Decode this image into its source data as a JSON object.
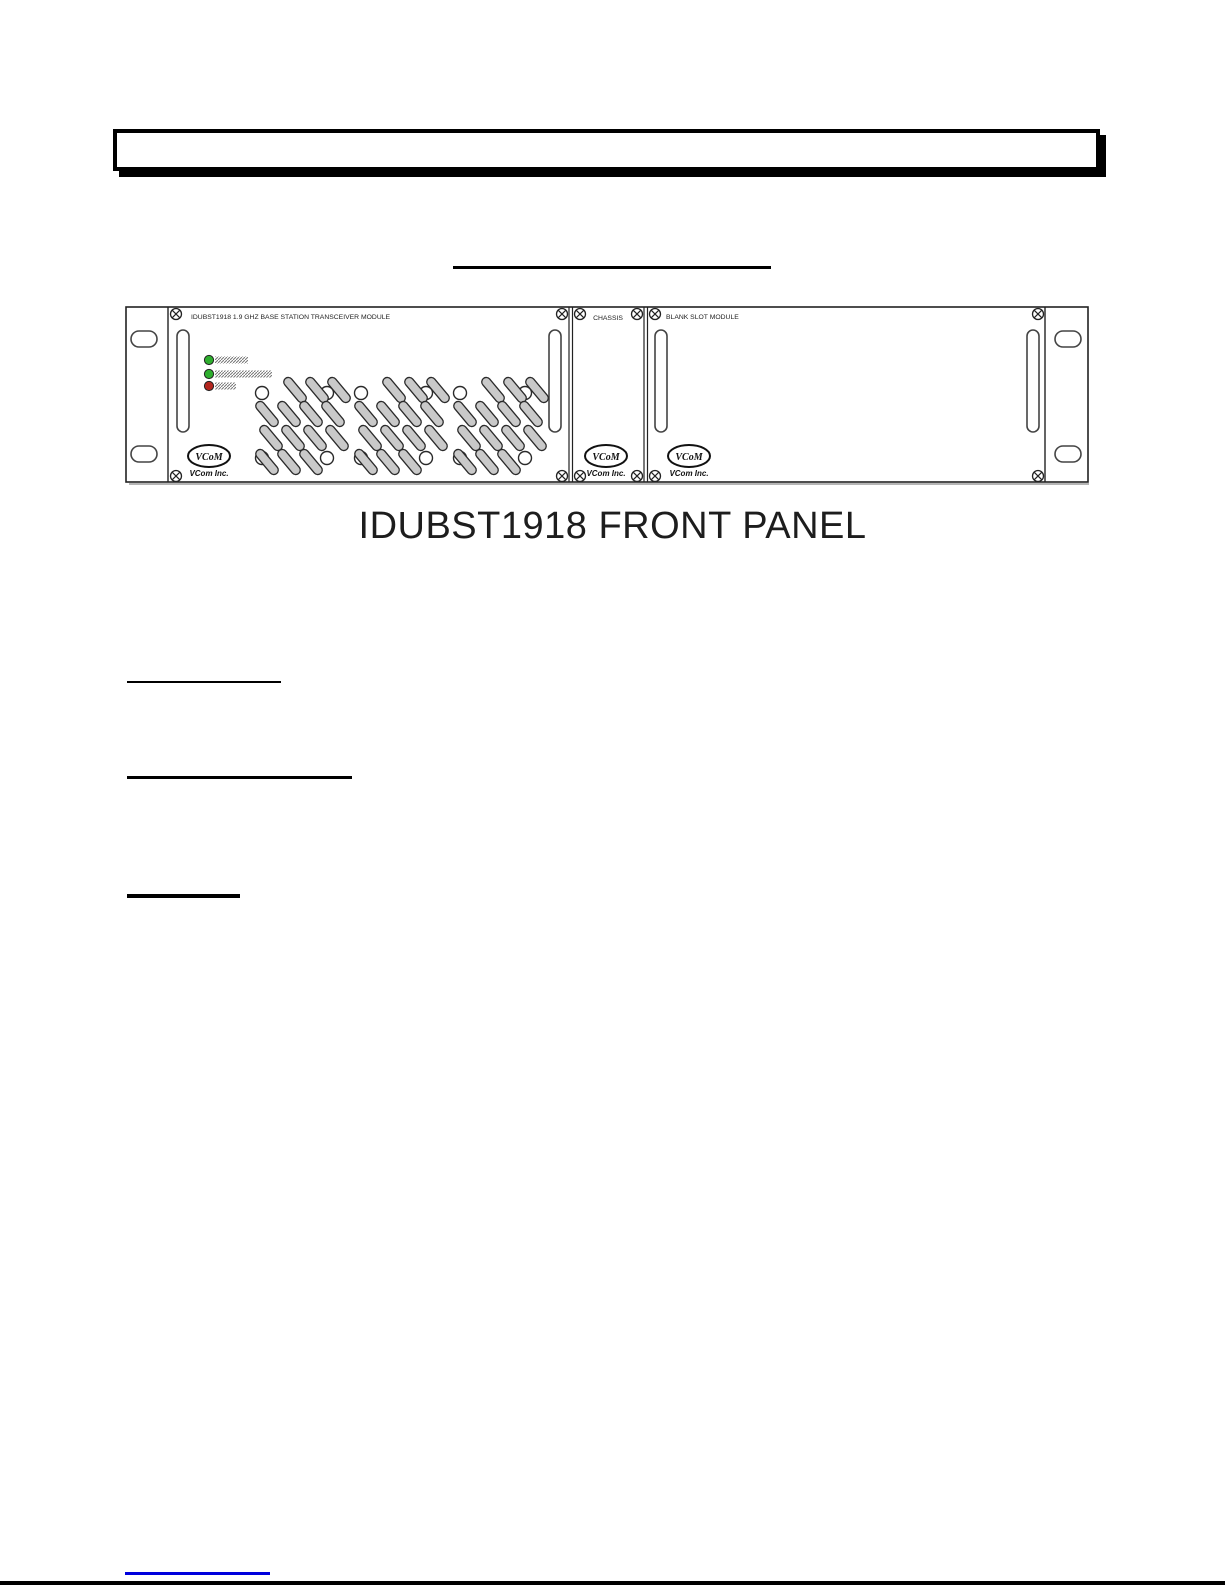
{
  "figure": {
    "caption": "IDUBST1918 FRONT PANEL",
    "chassis": {
      "left_module": {
        "title": "IDUBST1918 1.9 GHZ BASE STATION TRANSCEIVER MODULE",
        "leds": [
          {
            "name": "green-led-1",
            "color": "#2eae2e"
          },
          {
            "name": "green-led-2",
            "color": "#2eae2e"
          },
          {
            "name": "red-led",
            "color": "#b3261e"
          }
        ]
      },
      "center_section": {
        "title": "CHASSIS"
      },
      "right_module": {
        "title": "BLANK SLOT MODULE"
      },
      "brand": {
        "mark": "VCoM",
        "name": "VCom Inc."
      }
    }
  },
  "footer": {
    "link_color": "#0000dd"
  }
}
